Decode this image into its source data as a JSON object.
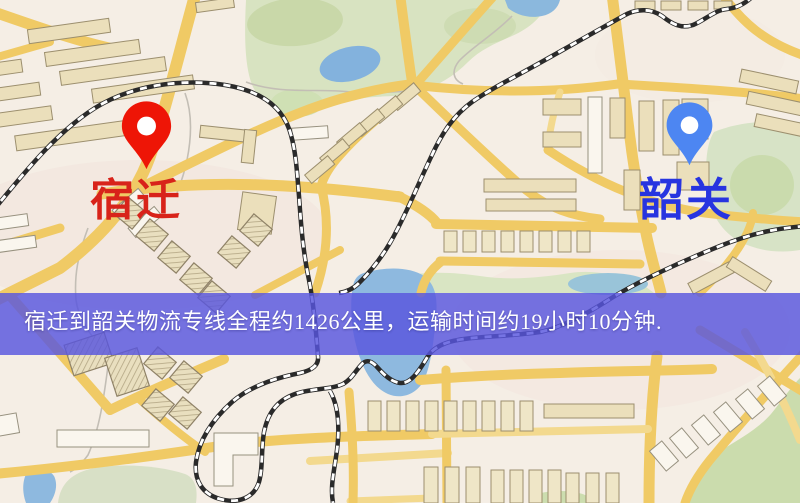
{
  "map": {
    "origin": {
      "name": "宿迁",
      "pin": "red-pin",
      "pin_color": "#EE1506",
      "label_color": "#D8231A"
    },
    "destination": {
      "name": "韶关",
      "pin": "blue-pin",
      "pin_color": "#4D86F2",
      "label_color": "#2734E0"
    }
  },
  "banner": {
    "text": "宿迁到韶关物流专线全程约1426公里，运输时间约19小时10分钟.",
    "background_color": "#5856DE",
    "text_color": "#FFFFFF",
    "distance_km": "1426",
    "transport_time": "19小时10分钟"
  },
  "palette": {
    "map_background": "#F5EEE5",
    "road_yellow": "#EFCA67",
    "park_green": "#D8E3C2",
    "water_blue": "#8FB9DE",
    "railway_black": "#2A2A2A",
    "building_tan": "#EBDFBC"
  }
}
